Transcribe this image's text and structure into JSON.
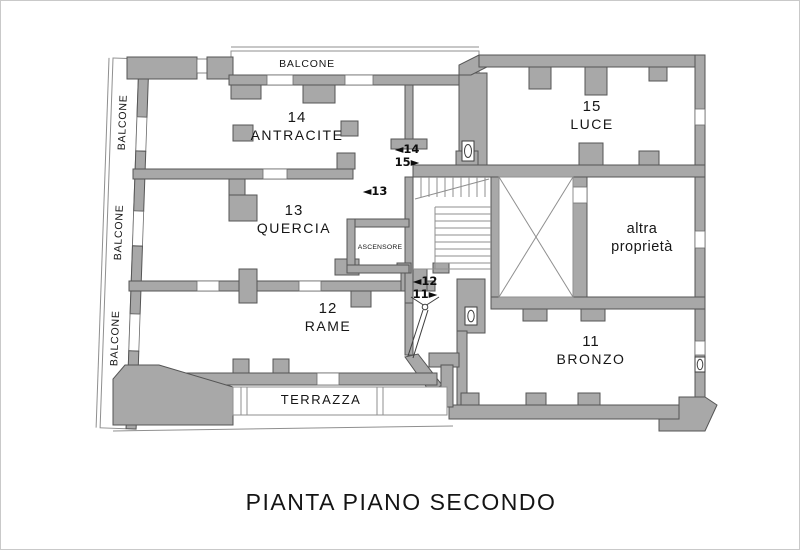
{
  "plan": {
    "title": "PIANTA PIANO SECONDO",
    "apartments": {
      "a14": {
        "number": "14",
        "name": "ANTRACITE"
      },
      "a15": {
        "number": "15",
        "name": "LUCE"
      },
      "a13": {
        "number": "13",
        "name": "QUERCIA"
      },
      "a12": {
        "number": "12",
        "name": "RAME"
      },
      "a11": {
        "number": "11",
        "name": "BRONZO"
      }
    },
    "other_property": {
      "line1": "altra",
      "line2": "proprietà"
    },
    "labels": {
      "balcony": "BALCONE",
      "terrace": "TERRAZZA",
      "elevator": "ASCENSORE"
    },
    "markers": {
      "m14": "◄14",
      "m15": "15►",
      "m13": "◄13",
      "m12": "◄12",
      "m11": "11►"
    },
    "colors": {
      "wall": "#a8a8a8",
      "wall_outline": "#555555",
      "thin_line": "#8f8f8f",
      "text": "#161616",
      "frame": "#c9c9c9",
      "background": "#ffffff"
    }
  }
}
